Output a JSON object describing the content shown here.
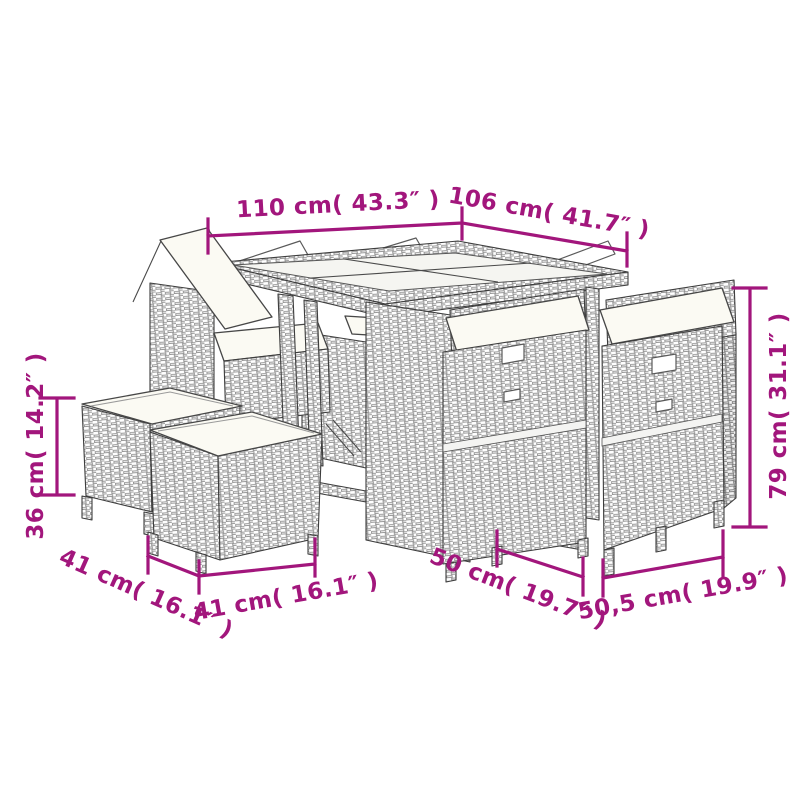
{
  "figure": {
    "type": "product-dimension-diagram",
    "subject": "poly-rattan-garden-dining-set-with-table-chairs-and-stools"
  },
  "palette": {
    "dimension_color": "#A2167C",
    "line_art_color": "#3d3d3d",
    "cushion_color": "#fbfaf3",
    "background": "#ffffff"
  },
  "dimensions": {
    "table_width": "110 cm( 43.3″ )",
    "table_depth": "106 cm( 41.7″ )",
    "chair_height": "79 cm( 31.1″ )",
    "stool_height": "36 cm( 14.2″ )",
    "stool_depth": "41 cm( 16.1″ )",
    "stool_width": "41 cm( 16.1″ )",
    "chair_depth": "50 cm( 19.7″ )",
    "chair_width": "50,5 cm( 19.9″ )"
  }
}
